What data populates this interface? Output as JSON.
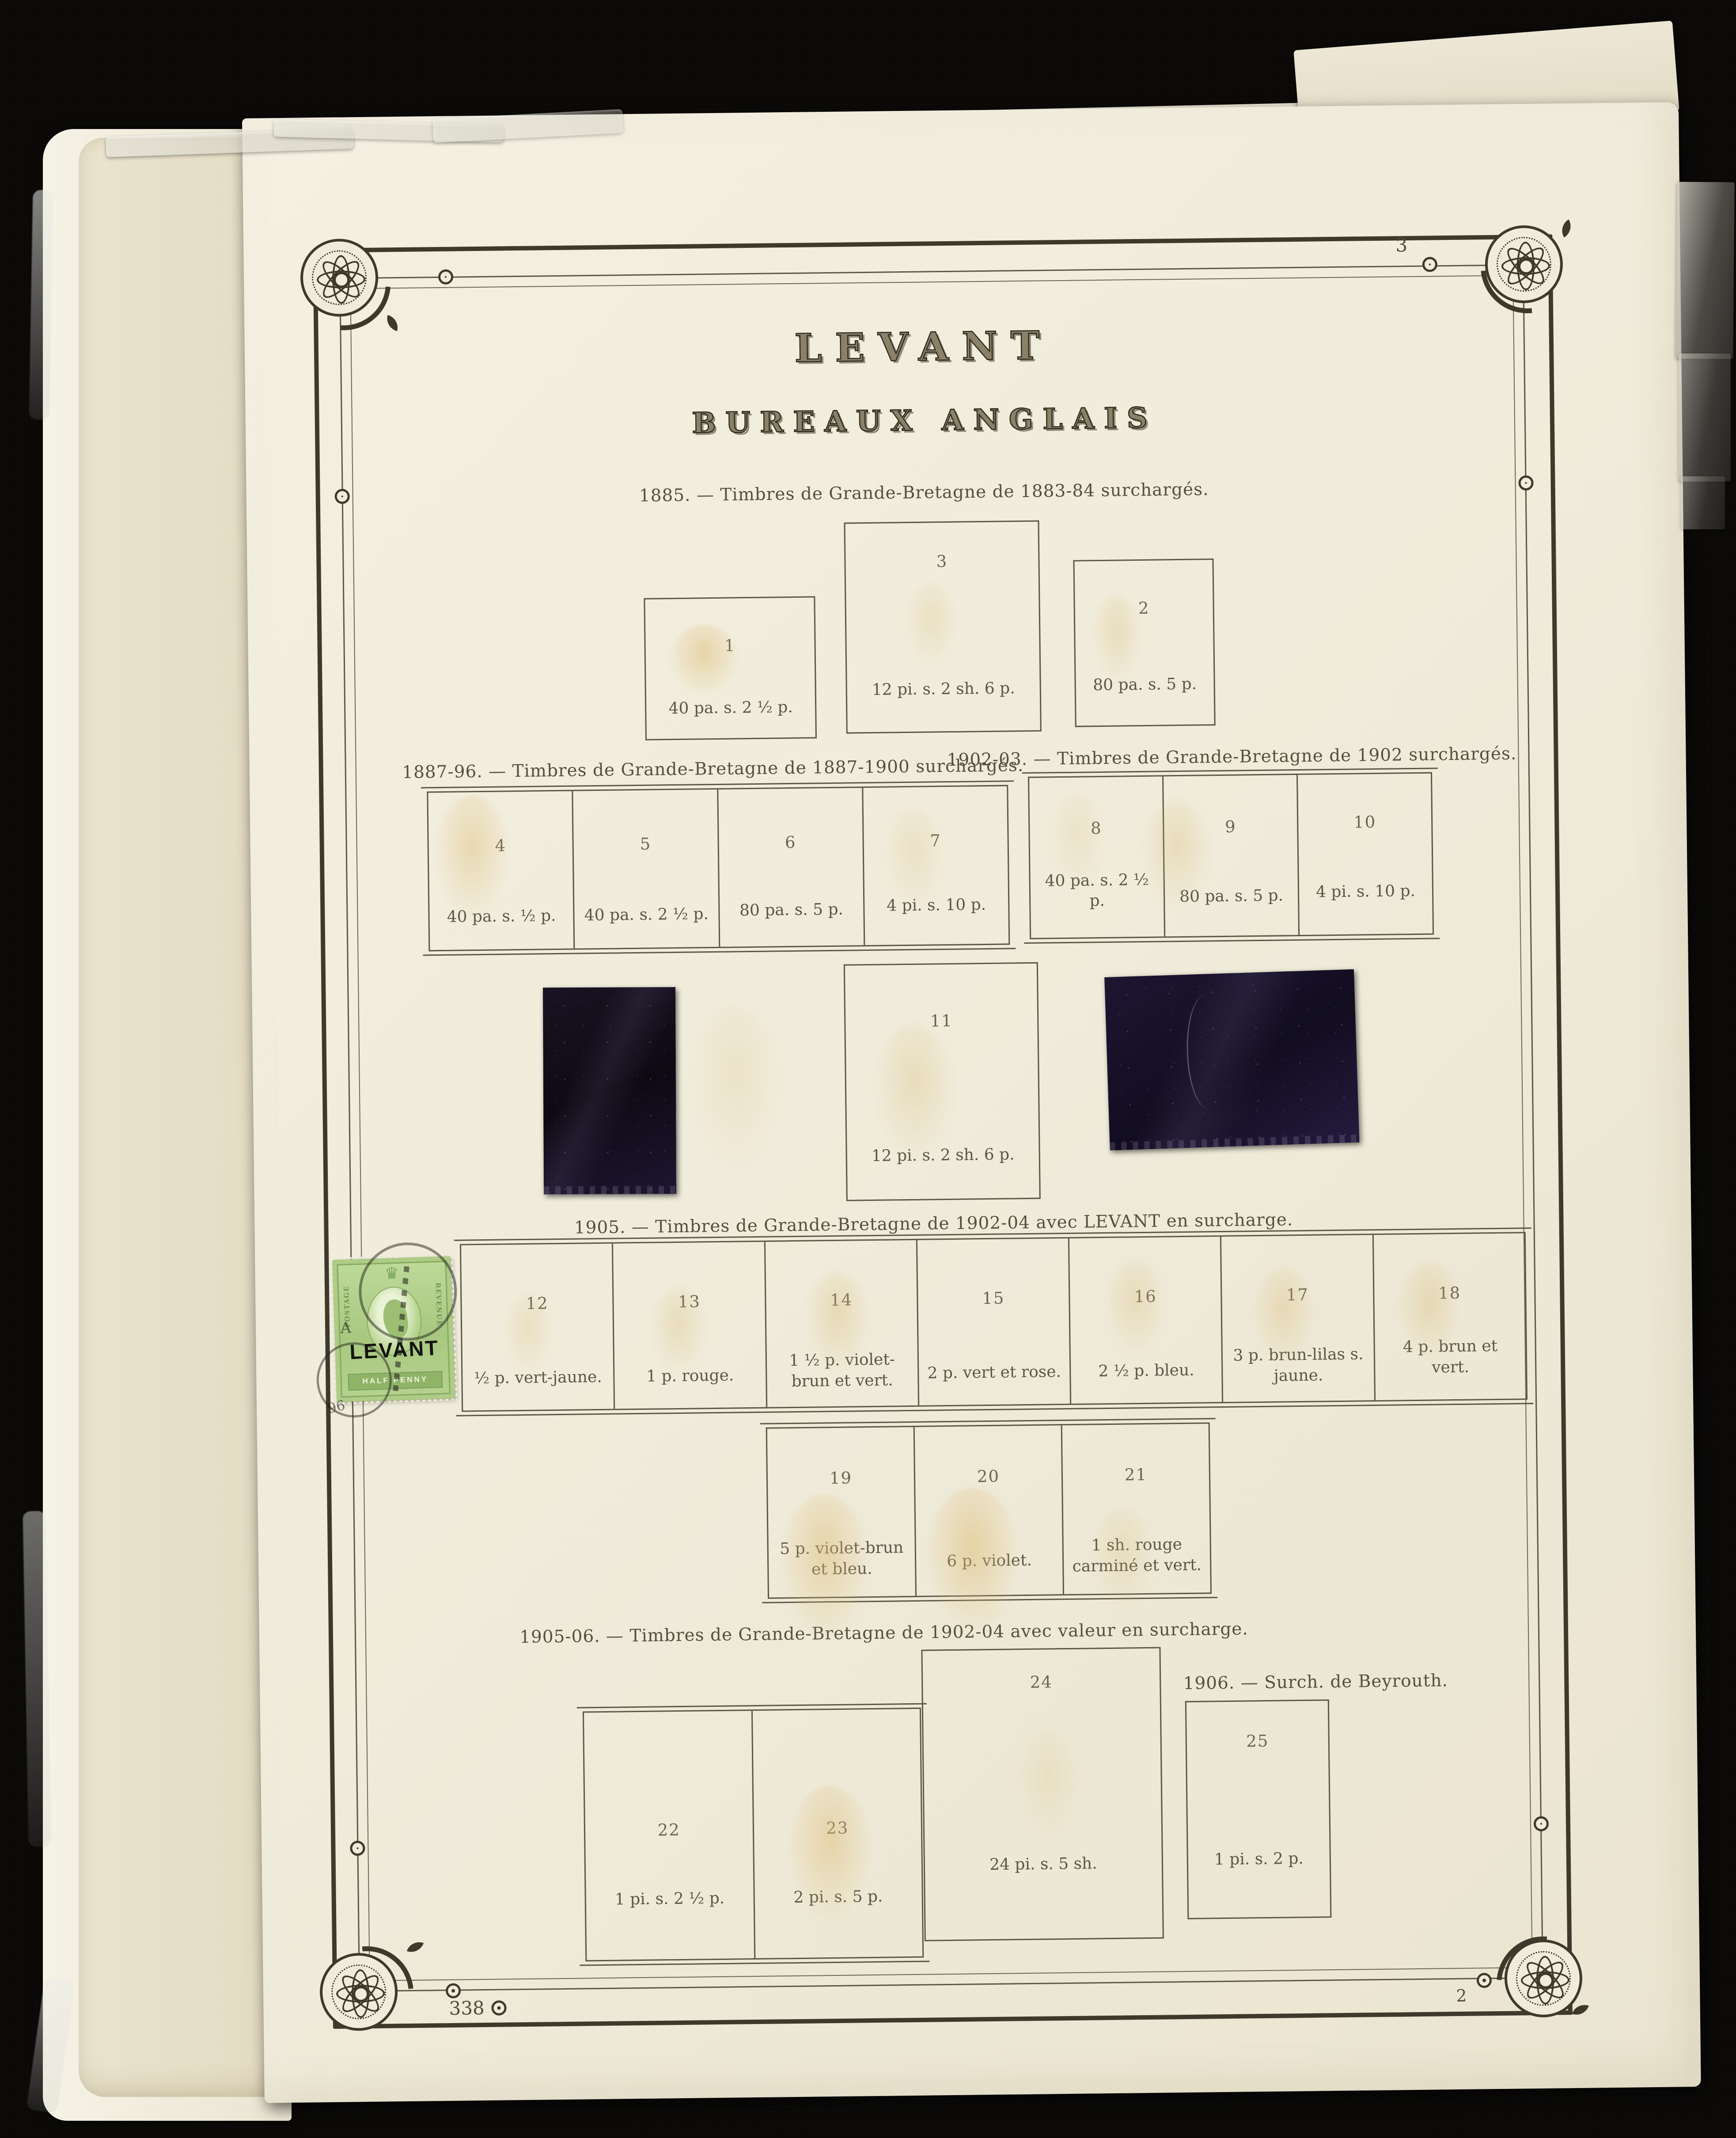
{
  "header": {
    "title": "LEVANT",
    "subtitle": "BUREAUX ANGLAIS"
  },
  "page_numbers": {
    "top_right": "3",
    "bottom_left": "338",
    "bottom_right": "2"
  },
  "sections": [
    {
      "caption": "1885. — Timbres de Grande-Bretagne de 1883-84 surchargés.",
      "boxes": [
        {
          "num": "1",
          "value": "40 pa. s. 2 ½ p."
        },
        {
          "num": "3",
          "value": "12 pi. s. 2 sh. 6 p."
        },
        {
          "num": "2",
          "value": "80 pa. s. 5 p."
        }
      ]
    },
    {
      "caption": "1887-96. — Timbres de Grande-Bretagne de 1887-1900 surchargés.",
      "boxes": [
        {
          "num": "4",
          "value": "40 pa. s. ½ p."
        },
        {
          "num": "5",
          "value": "40 pa. s. 2 ½ p."
        },
        {
          "num": "6",
          "value": "80 pa. s. 5 p."
        },
        {
          "num": "7",
          "value": "4 pi. s. 10 p."
        }
      ]
    },
    {
      "caption": "1902-03. — Timbres de Grande-Bretagne de 1902 surchargés.",
      "boxes": [
        {
          "num": "8",
          "value": "40 pa. s. 2 ½ p."
        },
        {
          "num": "9",
          "value": "80 pa. s. 5 p."
        },
        {
          "num": "10",
          "value": "4 pi. s. 10 p."
        }
      ]
    },
    {
      "caption": "1905. — Timbres de Grande-Bretagne de 1902-04 avec LEVANT en surcharge.",
      "boxes": [
        {
          "num": "12",
          "value": "½ p. vert-jaune."
        },
        {
          "num": "13",
          "value": "1 p. rouge."
        },
        {
          "num": "14",
          "value": "1 ½ p. violet-brun et vert."
        },
        {
          "num": "15",
          "value": "2 p. vert et rose."
        },
        {
          "num": "16",
          "value": "2 ½ p. bleu."
        },
        {
          "num": "17",
          "value": "3 p. brun-lilas s. jaune."
        },
        {
          "num": "18",
          "value": "4 p. brun et vert."
        }
      ],
      "boxes_row2": [
        {
          "num": "19",
          "value": "5 p. violet-brun et bleu."
        },
        {
          "num": "20",
          "value": "6 p. violet."
        },
        {
          "num": "21",
          "value": "1 sh. rouge carminé et vert."
        }
      ]
    },
    {
      "caption": "1905-06. — Timbres de Grande-Bretagne de 1902-04 avec valeur en surcharge.",
      "boxes": [
        {
          "num": "22",
          "value": "1 pi. s. 2 ½ p."
        },
        {
          "num": "23",
          "value": "2 pi. s. 5 p."
        },
        {
          "num": "24",
          "value": "24 pi. s. 5 sh."
        }
      ]
    },
    {
      "caption": "1906. — Surch. de Beyrouth.",
      "boxes": [
        {
          "num": "25",
          "value": "1 pi. s. 2 p."
        }
      ]
    }
  ],
  "middle_box": {
    "num": "11",
    "value": "12 pi. s. 2 sh. 6 p."
  },
  "stamp": {
    "overprint": "LEVANT",
    "denomination": "HALF PENNY",
    "left_arc": "POSTAGE",
    "right_arc": "REVENUE",
    "postmark_letter": "A",
    "postmark_digits": "96"
  }
}
